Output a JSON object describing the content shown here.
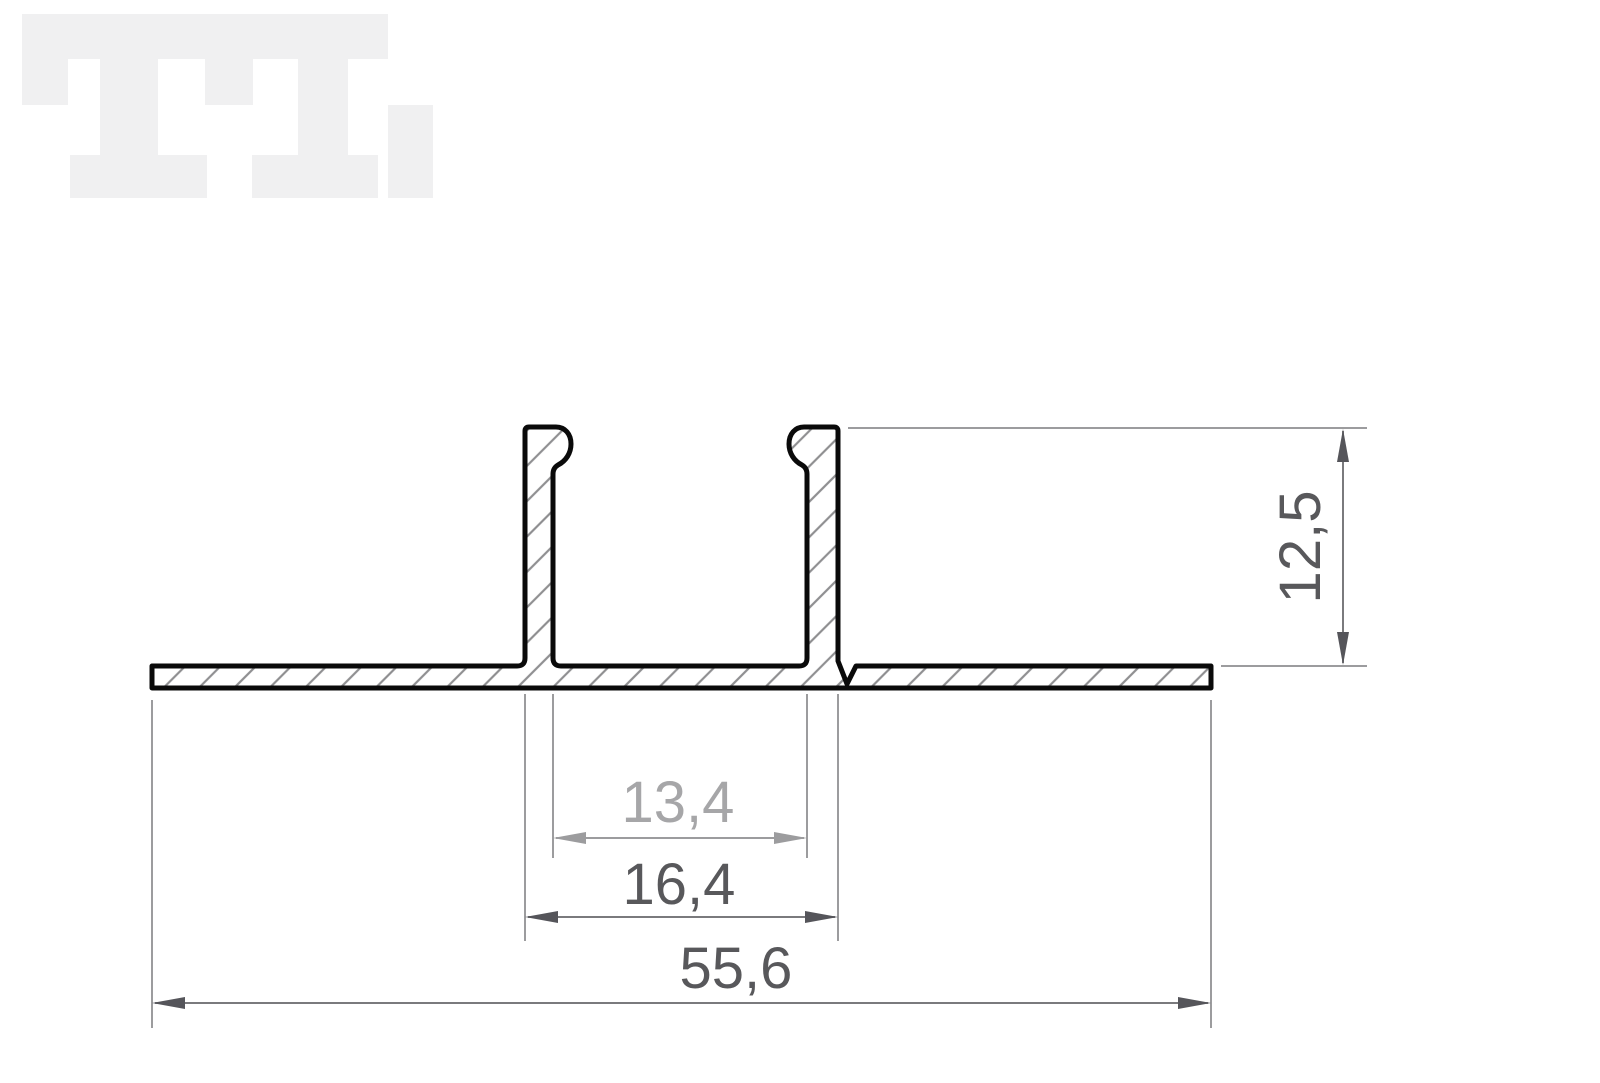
{
  "watermark": {
    "label": "TL-logo",
    "color": "#f0f0f1"
  },
  "drawing": {
    "background": "#ffffff",
    "outline_color": "#0a0a0a",
    "hatch_color": "#8f8f91",
    "extension_line_color": "#9c9c9e",
    "dimensions": {
      "height": {
        "label": "12,5",
        "orientation": "vertical",
        "text_color": "#58585b",
        "line_color": "#7a7a7d",
        "arrow_color": "#55555a"
      },
      "inner_width": {
        "label": "13,4",
        "orientation": "horizontal",
        "text_color": "#a6a6a8",
        "line_color": "#9c9c9e",
        "arrow_color": "#9c9c9e"
      },
      "outer_width": {
        "label": "16,4",
        "orientation": "horizontal",
        "text_color": "#58585b",
        "line_color": "#7a7a7d",
        "arrow_color": "#55555a"
      },
      "total_width": {
        "label": "55,6",
        "orientation": "horizontal",
        "text_color": "#58585b",
        "line_color": "#7a7a7d",
        "arrow_color": "#55555a"
      }
    }
  }
}
